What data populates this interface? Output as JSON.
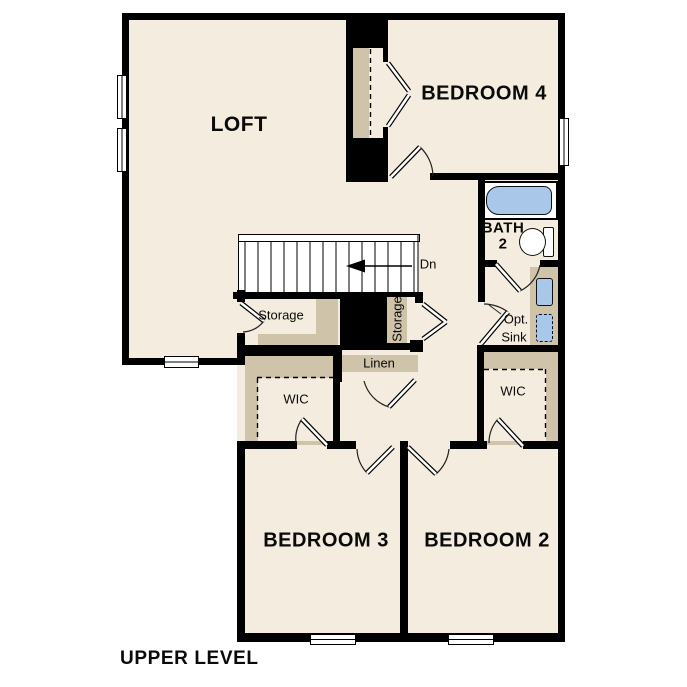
{
  "plan": {
    "title": "UPPER LEVEL",
    "rooms": {
      "loft": "LOFT",
      "bedroom4": "BEDROOM 4",
      "bedroom3": "BEDROOM 3",
      "bedroom2": "BEDROOM 2",
      "bath_line1": "BATH",
      "bath_line2": "2",
      "wic_left": "WIC",
      "wic_right": "WIC",
      "linen": "Linen",
      "storage_under_stairs": "Storage",
      "storage_closet": "Storage",
      "opt_sink_line1": "Opt.",
      "opt_sink_line2": "Sink",
      "stairs_down": "Dn"
    },
    "colors": {
      "floor": "#f4ecdf",
      "casework": "#cfc3aa",
      "fixture": "#a9c8e9",
      "wall": "#000000"
    }
  }
}
